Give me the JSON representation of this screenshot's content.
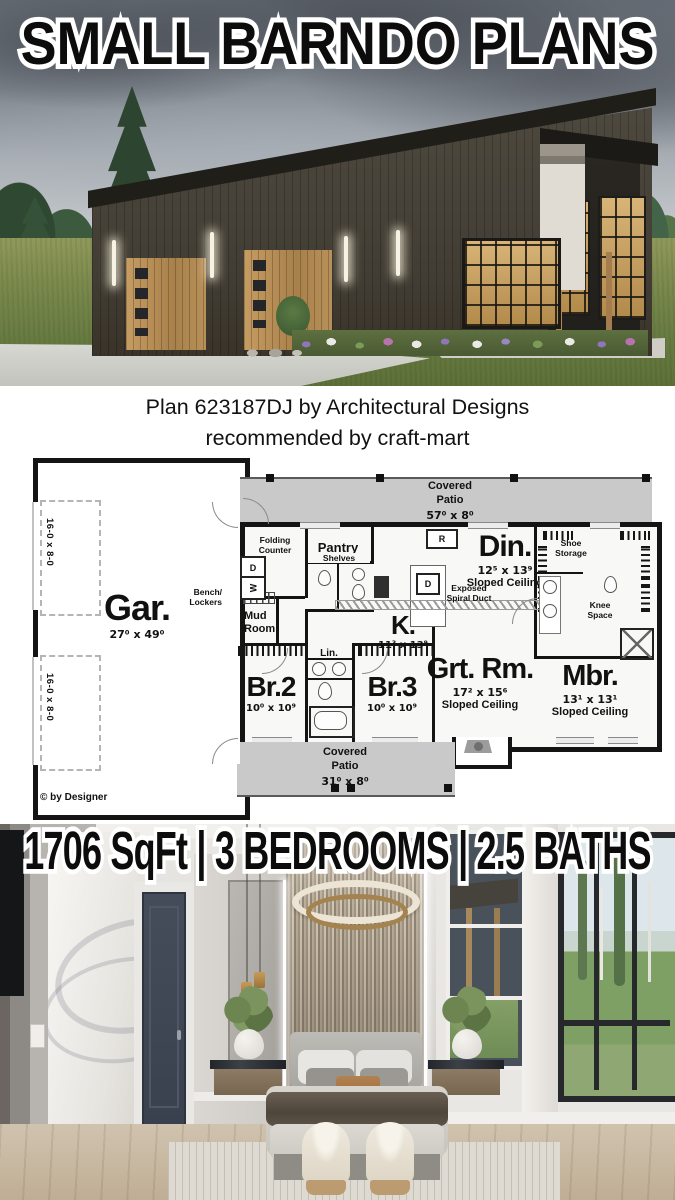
{
  "page_title": "SMALL BARNDO PLANS",
  "caption": {
    "line1": "Plan 623187DJ by Architectural Designs",
    "line2": "recommended by craft-mart"
  },
  "stats_text": "1706 SqFt | 3 BEDROOMS | 2.5 BATHS",
  "floor_plan": {
    "copyright": "© by Designer",
    "garage": {
      "name": "Gar.",
      "dims": "27⁰ x 49⁰",
      "door_labels": [
        "16-0 x 8-0",
        "16-0 x 8-0"
      ]
    },
    "patio_top": {
      "label": "Covered\nPatio",
      "dims": "57⁰ x 8⁰"
    },
    "patio_bottom": {
      "label": "Covered\nPatio",
      "dims": "31⁰ x 8⁰"
    },
    "rooms": {
      "dining": {
        "name": "Din.",
        "dims": "12⁵ x 13⁹",
        "note": "Sloped Ceiling"
      },
      "kitchen": {
        "name": "K.",
        "dims": "11³ x 13⁹"
      },
      "great_room": {
        "name": "Grt. Rm.",
        "dims": "17² x 15⁶",
        "note": "Sloped Ceiling"
      },
      "master_bedroom": {
        "name": "Mbr.",
        "dims": "13¹ x 13¹",
        "note": "Sloped Ceiling"
      },
      "bedroom2": {
        "name": "Br.2",
        "dims": "10⁰ x 10⁹"
      },
      "bedroom3": {
        "name": "Br.3",
        "dims": "10⁰ x 10⁹"
      },
      "mud_room": "Mud\nRoom",
      "pantry": "Pantry",
      "linen": "Lin."
    },
    "annotations": {
      "folding_counter": "Folding Counter",
      "shelves": "Shelves",
      "bench_lockers": "Bench/\nLockers",
      "shoe_storage": "Shoe\nStorage",
      "knee_space": "Knee\nSpace",
      "spiral_duct": "Exposed\nSpiral Duct",
      "washer": "W",
      "dryer": "D",
      "dishwasher": "D",
      "refrigerator": "R"
    }
  },
  "colors": {
    "plan_patio": "#c9c9c9",
    "wall": "#141414",
    "accent_wood": "#b9905a"
  }
}
